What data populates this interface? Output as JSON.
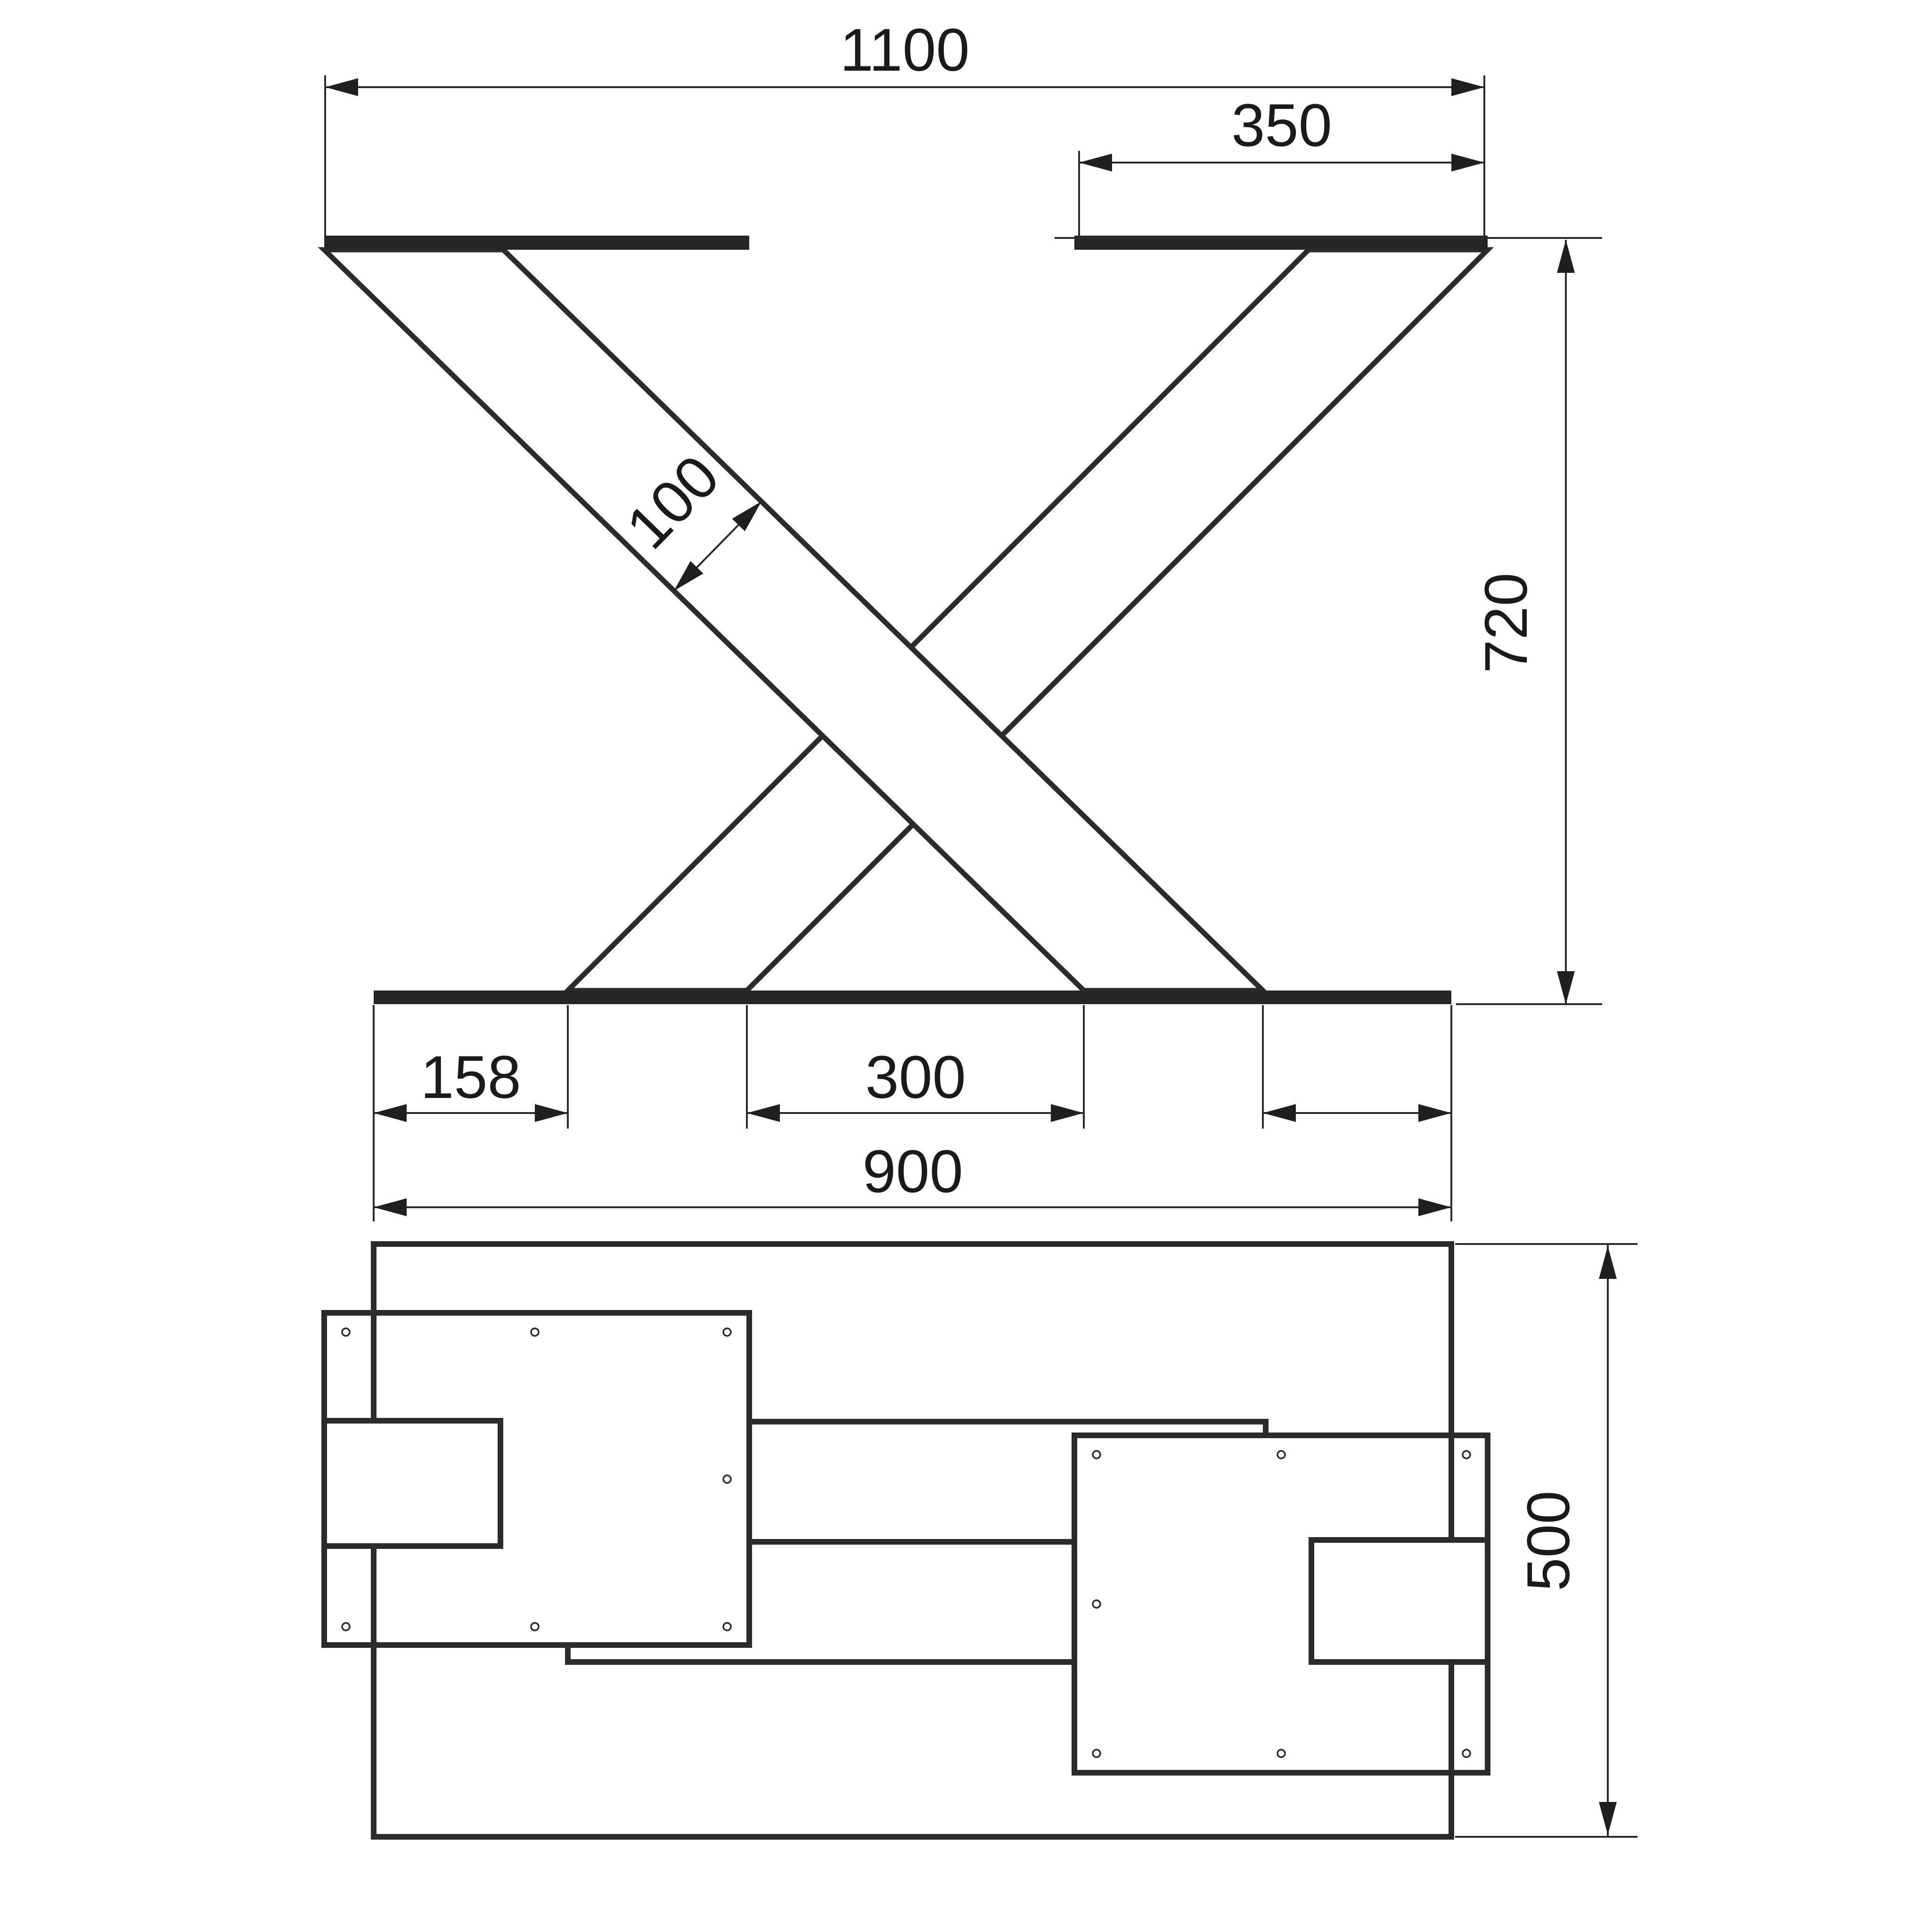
{
  "drawing": {
    "front_view": {
      "dim_overall_width": "1100",
      "dim_top_plate_width": "350",
      "dim_leg_width": "100",
      "dim_height": "720",
      "dim_foot_end_offset": "158",
      "dim_foot_center_gap": "300",
      "dim_foot_length": "900"
    },
    "plan_view": {
      "dim_depth": "500"
    },
    "colors": {
      "line": "#2b2b2b",
      "background": "#ffffff"
    }
  }
}
